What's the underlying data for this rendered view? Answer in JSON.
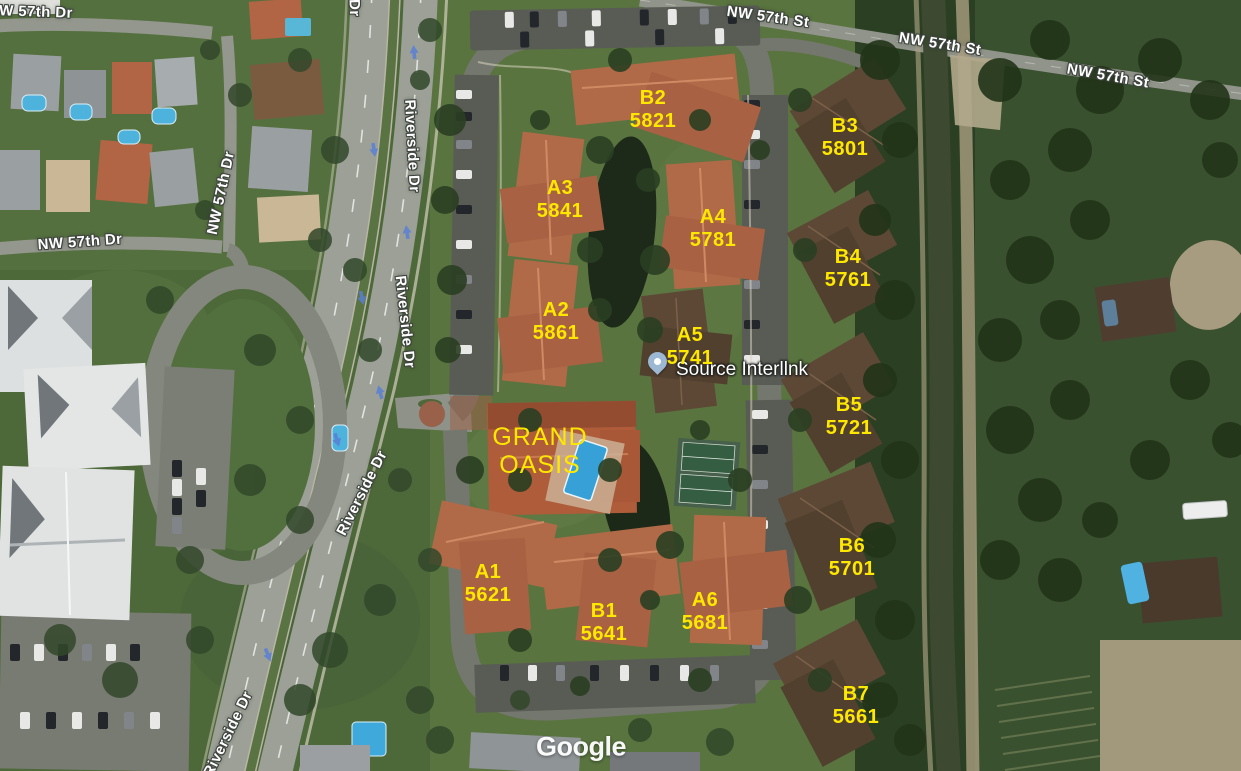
{
  "map": {
    "watermark": "Google",
    "complex_name": {
      "line1": "GRAND",
      "line2": "OASIS"
    },
    "marker": {
      "name": "Source Interllnk"
    },
    "buildings": [
      {
        "code": "B2",
        "address": "5821"
      },
      {
        "code": "B3",
        "address": "5801"
      },
      {
        "code": "A3",
        "address": "5841"
      },
      {
        "code": "A4",
        "address": "5781"
      },
      {
        "code": "B4",
        "address": "5761"
      },
      {
        "code": "A2",
        "address": "5861"
      },
      {
        "code": "A5",
        "address": "5741"
      },
      {
        "code": "B5",
        "address": "5721"
      },
      {
        "code": "A1",
        "address": "5621"
      },
      {
        "code": "B1",
        "address": "5641"
      },
      {
        "code": "A6",
        "address": "5681"
      },
      {
        "code": "B6",
        "address": "5701"
      },
      {
        "code": "B7",
        "address": "5661"
      }
    ],
    "street_labels": [
      {
        "name": "W 57th Dr"
      },
      {
        "name": "NW 57th Dr"
      },
      {
        "name": "NW 57th Dr"
      },
      {
        "name": "NW 57th St"
      },
      {
        "name": "NW 57th St"
      },
      {
        "name": "NW 57th St"
      },
      {
        "name": "Riverside Dr"
      },
      {
        "name": "Riverside Dr"
      },
      {
        "name": "Riverside Dr"
      },
      {
        "name": "Riverside Dr"
      },
      {
        "name": "Riverside Dr"
      }
    ],
    "colors": {
      "building_label": "#ffe800",
      "street_text": "#ffffff",
      "marker_fill": "#9cb8d2"
    }
  }
}
